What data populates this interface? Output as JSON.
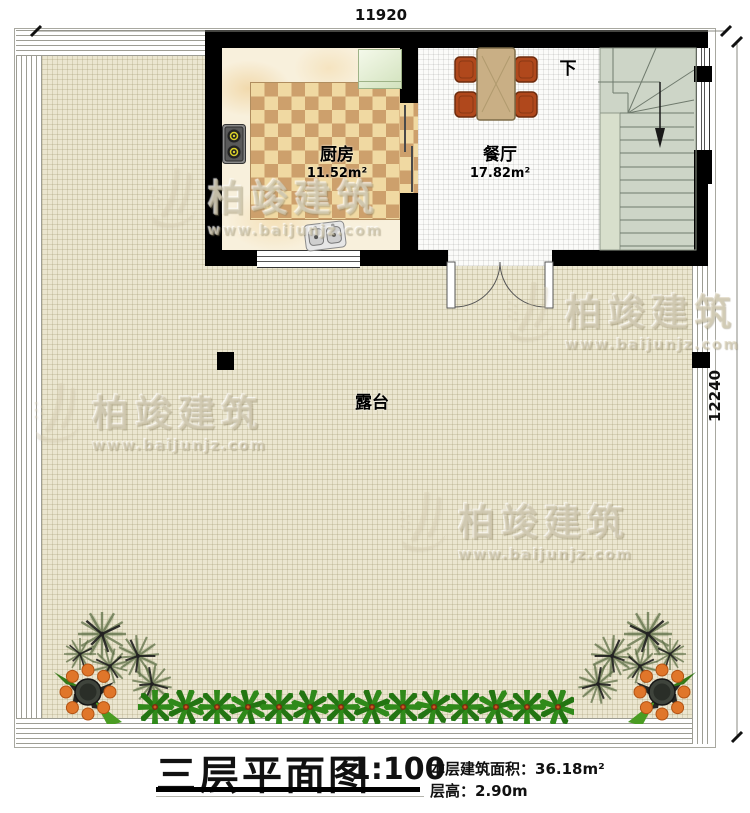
{
  "dimensions": {
    "top": "11920",
    "right": "12240"
  },
  "rooms": {
    "kitchen": {
      "name": "厨房",
      "area": "11.52m²"
    },
    "dining": {
      "name": "餐厅",
      "area": "17.82m²"
    },
    "terrace": {
      "name": "露台"
    },
    "stairs": {
      "down_label": "下"
    }
  },
  "title_block": {
    "title": "三层平面图",
    "scale": "1:100",
    "area_label": "本层建筑面积：",
    "area_value": "36.18m²",
    "height_label": "层高：",
    "height_value": "2.90m"
  },
  "watermark": {
    "brand": "柏竣建筑",
    "url": "www.baijunjz.com"
  },
  "colors": {
    "wall": "#000000",
    "terrace_floor": "#ebe6d0",
    "stair_floor": "#cdd5c7",
    "rug_light": "#f0d9a2",
    "rug_dark": "#cda06c",
    "chair": "#b0481c",
    "table": "#c9af85",
    "fridge": "#dcead0",
    "plant_green": "#2f8a1a",
    "fruit_orange": "#e0762a"
  }
}
